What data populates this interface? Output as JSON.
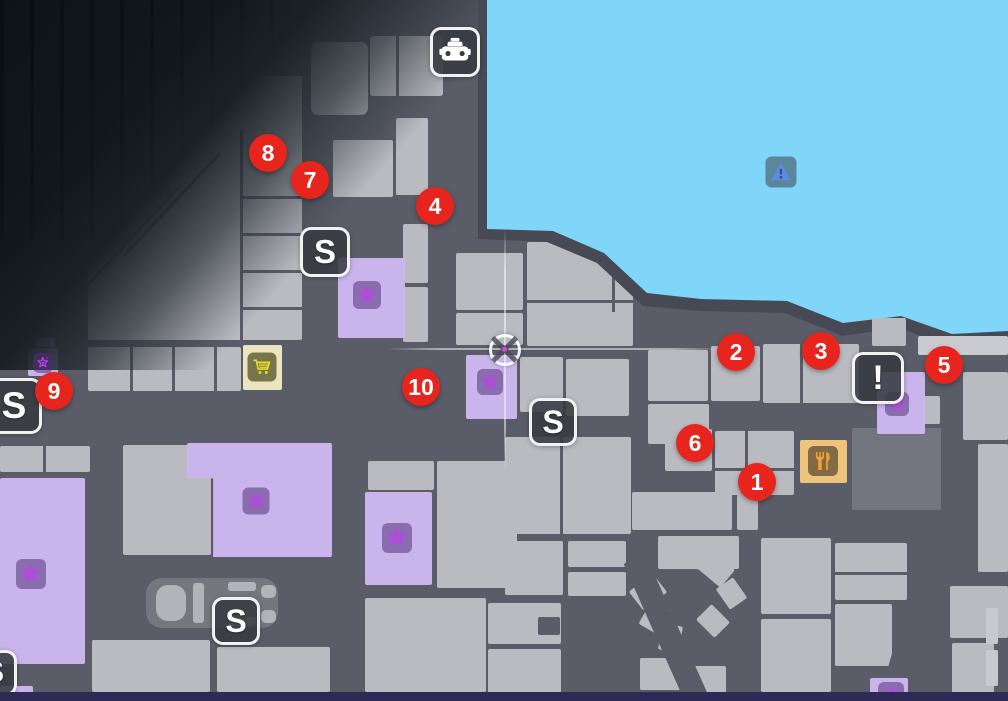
{
  "map": {
    "colors": {
      "road": "#5a5d67",
      "building": "#b9bbc1",
      "bl": "#c8cacf",
      "bd": "#74767f",
      "p": "#c9b4ec",
      "cream": "#ebe5bf",
      "tan": "#eec47d",
      "water": "#7fd6f8",
      "shore": "#474a54",
      "dark_fog": "#11181c",
      "marker_red": "#e8251d",
      "marker_text": "#ffffff",
      "badge_bg": "rgba(56,58,66,0.88)",
      "badge_border": "rgba(252,252,252,0.95)",
      "star_purple": "#c43df2",
      "star_box": "rgba(78,44,118,0.52)",
      "cart_box": "rgba(86,86,40,0.78)",
      "cart_glyph": "#e8d830",
      "food_box": "rgba(108,92,58,0.85)",
      "food_glyph": "#f2a235",
      "warn_box": "rgba(62,70,84,0.55)",
      "warn_glyph": "#5b8be6",
      "edge_navy": "#2e2a55",
      "pad": "#75777f",
      "car": "#b2b4ba",
      "waypoint_dot": "#e23cea"
    },
    "markers": [
      {
        "label": "1",
        "x": 757,
        "y": 482
      },
      {
        "label": "2",
        "x": 736,
        "y": 352
      },
      {
        "label": "3",
        "x": 821,
        "y": 351
      },
      {
        "label": "4",
        "x": 435,
        "y": 206
      },
      {
        "label": "5",
        "x": 944,
        "y": 365
      },
      {
        "label": "6",
        "x": 695,
        "y": 443
      },
      {
        "label": "7",
        "x": 310,
        "y": 180
      },
      {
        "label": "8",
        "x": 268,
        "y": 153
      },
      {
        "label": "9",
        "x": 54,
        "y": 391
      },
      {
        "label": "10",
        "x": 421,
        "y": 387
      }
    ],
    "badges": [
      {
        "name": "taxi-icon",
        "cx": 455,
        "cy": 52,
        "size": 50,
        "type": "taxi"
      },
      {
        "name": "s-badge-icon",
        "cx": 325,
        "cy": 252,
        "size": 50,
        "type": "letter",
        "glyph": "S"
      },
      {
        "name": "s-badge-icon",
        "cx": 553,
        "cy": 422,
        "size": 48,
        "type": "letter",
        "glyph": "S"
      },
      {
        "name": "s-badge-icon",
        "cx": 236,
        "cy": 621,
        "size": 48,
        "type": "letter",
        "glyph": "S"
      },
      {
        "name": "s-badge-icon",
        "cx": 14,
        "cy": 406,
        "size": 56,
        "type": "letter",
        "glyph": "S"
      },
      {
        "name": "s-badge-icon",
        "cx": -6,
        "cy": 673,
        "size": 46,
        "type": "letter",
        "glyph": "S"
      },
      {
        "name": "alert-badge-icon",
        "cx": 878,
        "cy": 378,
        "size": 52,
        "type": "letter",
        "glyph": "!"
      }
    ],
    "minis": [
      {
        "name": "shop-cart-icon",
        "cx": 262,
        "cy": 367,
        "size": 29,
        "type": "cart"
      },
      {
        "name": "restaurant-icon",
        "cx": 823,
        "cy": 461,
        "size": 30,
        "type": "food"
      },
      {
        "name": "water-warning-icon",
        "cx": 781,
        "cy": 172,
        "size": 31,
        "type": "warn"
      }
    ],
    "stars": [
      {
        "icon": "star-icon",
        "cx": 367,
        "cy": 295,
        "size": 28
      },
      {
        "icon": "star-icon",
        "cx": 490,
        "cy": 382,
        "size": 26
      },
      {
        "icon": "star-icon",
        "cx": 43,
        "cy": 363,
        "size": 20
      },
      {
        "icon": "star-icon",
        "cx": 31,
        "cy": 574,
        "size": 30
      },
      {
        "icon": "star-icon",
        "cx": 256,
        "cy": 501,
        "size": 27
      },
      {
        "icon": "star-icon",
        "cx": 397,
        "cy": 538,
        "size": 30
      },
      {
        "icon": "star-icon",
        "cx": 897,
        "cy": 404,
        "size": 24
      },
      {
        "icon": "star-icon",
        "cx": 891,
        "cy": 695,
        "size": 26
      }
    ],
    "waypoint": {
      "icon": "waypoint-crosshair-icon",
      "cx": 505,
      "cy": 350,
      "vline": {
        "x": 505,
        "y1": 228,
        "y2": 472
      },
      "hline": {
        "y": 349,
        "x1": 388,
        "x2": 722
      }
    },
    "parking": {
      "pad": {
        "x": 146,
        "y": 578,
        "w": 132,
        "h": 50
      },
      "car_parts": [
        {
          "x": 156,
          "y": 585,
          "w": 30,
          "h": 36,
          "r": 12
        },
        {
          "x": 193,
          "y": 583,
          "w": 11,
          "h": 40,
          "r": 3
        },
        {
          "x": 228,
          "y": 582,
          "w": 28,
          "h": 9,
          "r": 3
        },
        {
          "x": 228,
          "y": 617,
          "w": 28,
          "h": 9,
          "r": 3
        },
        {
          "x": 261,
          "y": 585,
          "w": 15,
          "h": 13,
          "r": 5
        },
        {
          "x": 261,
          "y": 610,
          "w": 15,
          "h": 13,
          "r": 5
        }
      ]
    },
    "rects": [
      {
        "x": 88,
        "y": 76,
        "w": 214,
        "h": 264,
        "clip": "polygon(0% 100%, 0% 55%, 63.5% 0%, 100% 0%, 100% 100%)"
      },
      {
        "x": 311,
        "y": 42,
        "w": 57,
        "h": 73,
        "r": 7
      },
      {
        "x": 370,
        "y": 36,
        "w": 73,
        "h": 60,
        "r": 3
      },
      {
        "x": 333,
        "y": 140,
        "w": 60,
        "h": 57
      },
      {
        "x": 396,
        "y": 118,
        "w": 32,
        "h": 77
      },
      {
        "x": 403,
        "y": 224,
        "w": 25,
        "h": 59
      },
      {
        "x": 403,
        "y": 287,
        "w": 25,
        "h": 55
      },
      {
        "x": 456,
        "y": 253,
        "w": 67,
        "h": 57
      },
      {
        "x": 527,
        "y": 242,
        "w": 106,
        "h": 104
      },
      {
        "x": 456,
        "y": 313,
        "w": 67,
        "h": 32
      },
      {
        "x": 520,
        "y": 357,
        "w": 43,
        "h": 55
      },
      {
        "x": 566,
        "y": 359,
        "w": 63,
        "h": 57
      },
      {
        "x": 505,
        "y": 437,
        "w": 126,
        "h": 97
      },
      {
        "x": 88,
        "y": 347,
        "w": 153,
        "h": 44
      },
      {
        "x": 648,
        "y": 350,
        "w": 60,
        "h": 51
      },
      {
        "x": 711,
        "y": 346,
        "w": 49,
        "h": 55
      },
      {
        "x": 763,
        "y": 344,
        "w": 96,
        "h": 59
      },
      {
        "x": 648,
        "y": 404,
        "w": 61,
        "h": 40
      },
      {
        "x": 665,
        "y": 429,
        "w": 47,
        "h": 42
      },
      {
        "x": 715,
        "y": 431,
        "w": 79,
        "h": 64
      },
      {
        "x": 852,
        "y": 428,
        "w": 89,
        "h": 82,
        "c": "bd"
      },
      {
        "x": 900,
        "y": 396,
        "w": 40,
        "h": 28
      },
      {
        "x": 963,
        "y": 372,
        "w": 45,
        "h": 68
      },
      {
        "x": 978,
        "y": 444,
        "w": 30,
        "h": 128
      },
      {
        "x": 0,
        "y": 446,
        "w": 90,
        "h": 26
      },
      {
        "x": 123,
        "y": 445,
        "w": 88,
        "h": 110
      },
      {
        "x": 92,
        "y": 640,
        "w": 118,
        "h": 52
      },
      {
        "x": 217,
        "y": 647,
        "w": 113,
        "h": 45
      },
      {
        "x": 368,
        "y": 461,
        "w": 66,
        "h": 29
      },
      {
        "x": 437,
        "y": 461,
        "w": 80,
        "h": 127
      },
      {
        "x": 365,
        "y": 598,
        "w": 121,
        "h": 94
      },
      {
        "x": 488,
        "y": 603,
        "w": 73,
        "h": 41
      },
      {
        "x": 488,
        "y": 649,
        "w": 73,
        "h": 44
      },
      {
        "x": 505,
        "y": 541,
        "w": 58,
        "h": 54
      },
      {
        "x": 568,
        "y": 541,
        "w": 58,
        "h": 26
      },
      {
        "x": 568,
        "y": 572,
        "w": 58,
        "h": 24
      },
      {
        "x": 632,
        "y": 492,
        "w": 100,
        "h": 38
      },
      {
        "x": 737,
        "y": 492,
        "w": 21,
        "h": 38
      },
      {
        "x": 658,
        "y": 536,
        "w": 81,
        "h": 33
      },
      {
        "x": 761,
        "y": 538,
        "w": 70,
        "h": 76
      },
      {
        "x": 761,
        "y": 619,
        "w": 70,
        "h": 73
      },
      {
        "x": 835,
        "y": 543,
        "w": 72,
        "h": 57
      },
      {
        "x": 835,
        "y": 604,
        "w": 57,
        "h": 62
      },
      {
        "x": 633,
        "y": 580,
        "w": 30,
        "h": 24,
        "rot": -38
      },
      {
        "x": 641,
        "y": 606,
        "w": 28,
        "h": 22,
        "rot": -60
      },
      {
        "x": 657,
        "y": 628,
        "w": 27,
        "h": 20,
        "rot": -78
      },
      {
        "x": 676,
        "y": 545,
        "w": 27,
        "h": 22,
        "rot": 14
      },
      {
        "x": 702,
        "y": 558,
        "w": 29,
        "h": 23,
        "rot": 40
      },
      {
        "x": 719,
        "y": 583,
        "w": 25,
        "h": 21,
        "rot": 55
      },
      {
        "x": 700,
        "y": 610,
        "w": 26,
        "h": 22,
        "rot": 45
      },
      {
        "x": 640,
        "y": 658,
        "w": 42,
        "h": 32
      },
      {
        "x": 690,
        "y": 666,
        "w": 36,
        "h": 28
      },
      {
        "x": 655,
        "y": 552,
        "w": 24,
        "h": 160,
        "rot": -24,
        "c": "road",
        "n": "road"
      },
      {
        "x": 896,
        "y": 568,
        "w": 48,
        "h": 150,
        "rot": 16,
        "c": "road",
        "n": "road"
      },
      {
        "x": 950,
        "y": 586,
        "w": 58,
        "h": 52
      },
      {
        "x": 952,
        "y": 643,
        "w": 42,
        "h": 50
      },
      {
        "x": 986,
        "y": 608,
        "w": 12,
        "h": 36,
        "c": "bl"
      },
      {
        "x": 986,
        "y": 650,
        "w": 12,
        "h": 36,
        "c": "bl"
      },
      {
        "x": 538,
        "y": 617,
        "w": 22,
        "h": 18,
        "c": "road",
        "n": "courtyard"
      },
      {
        "x": 338,
        "y": 258,
        "w": 67,
        "h": 80,
        "c": "p",
        "n": "landmark-building"
      },
      {
        "x": 466,
        "y": 355,
        "w": 51,
        "h": 64,
        "c": "p",
        "n": "landmark-building"
      },
      {
        "x": 28,
        "y": 348,
        "w": 30,
        "h": 28,
        "c": "p",
        "n": "landmark-building"
      },
      {
        "x": 36,
        "y": 338,
        "w": 19,
        "h": 9,
        "c": "p",
        "n": "landmark-building"
      },
      {
        "x": 0,
        "y": 478,
        "w": 85,
        "h": 186,
        "c": "p",
        "n": "landmark-building"
      },
      {
        "x": 187,
        "y": 443,
        "w": 145,
        "h": 114,
        "c": "p",
        "n": "landmark-building",
        "clip": "polygon(0 0,100% 0,100% 100%,18% 100%,18% 31%,0 31%)"
      },
      {
        "x": 365,
        "y": 492,
        "w": 67,
        "h": 93,
        "c": "p",
        "n": "landmark-building"
      },
      {
        "x": 877,
        "y": 372,
        "w": 48,
        "h": 62,
        "c": "p",
        "n": "landmark-building"
      },
      {
        "x": 870,
        "y": 678,
        "w": 38,
        "h": 23,
        "c": "p",
        "n": "landmark-building"
      },
      {
        "x": 0,
        "y": 686,
        "w": 33,
        "h": 15,
        "c": "p",
        "n": "landmark-building"
      },
      {
        "x": 243,
        "y": 345,
        "w": 39,
        "h": 45,
        "c": "cream",
        "n": "shop-building"
      },
      {
        "x": 800,
        "y": 440,
        "w": 47,
        "h": 43,
        "c": "tan",
        "n": "restaurant-building"
      }
    ],
    "over_rects": [
      {
        "x": 872,
        "y": 318,
        "w": 34,
        "h": 28,
        "n": "pier"
      },
      {
        "x": 918,
        "y": 336,
        "w": 90,
        "h": 19,
        "c": "bl",
        "n": "dock"
      }
    ],
    "lines": [
      {
        "x": 240,
        "y": 130,
        "w": 2.5,
        "h": 210
      },
      {
        "x": 240,
        "y": 196,
        "w": 62,
        "h": 2.5
      },
      {
        "x": 240,
        "y": 233,
        "w": 62,
        "h": 2.5
      },
      {
        "x": 240,
        "y": 270,
        "w": 62,
        "h": 2.5
      },
      {
        "x": 240,
        "y": 307,
        "w": 62,
        "h": 2.5
      },
      {
        "x": 128,
        "y": 170,
        "w": 2.5,
        "h": 140,
        "rot": 43
      },
      {
        "x": 170,
        "y": 135,
        "w": 2.5,
        "h": 140,
        "rot": 43
      },
      {
        "x": 130,
        "y": 347,
        "w": 2.5,
        "h": 44
      },
      {
        "x": 172,
        "y": 347,
        "w": 2.5,
        "h": 44
      },
      {
        "x": 214,
        "y": 347,
        "w": 2.5,
        "h": 44
      },
      {
        "x": 396,
        "y": 36,
        "w": 2.5,
        "h": 60
      },
      {
        "x": 612,
        "y": 268,
        "w": 2.5,
        "h": 44
      },
      {
        "x": 527,
        "y": 300,
        "w": 106,
        "h": 2.5
      },
      {
        "x": 560,
        "y": 437,
        "w": 2.5,
        "h": 97
      },
      {
        "x": 745,
        "y": 431,
        "w": 2.5,
        "h": 64
      },
      {
        "x": 715,
        "y": 468,
        "w": 79,
        "h": 2.5
      },
      {
        "x": 800,
        "y": 344,
        "w": 2.5,
        "h": 59
      },
      {
        "x": 43,
        "y": 446,
        "w": 2.5,
        "h": 26
      },
      {
        "x": 835,
        "y": 572,
        "w": 72,
        "h": 2.5
      }
    ]
  }
}
